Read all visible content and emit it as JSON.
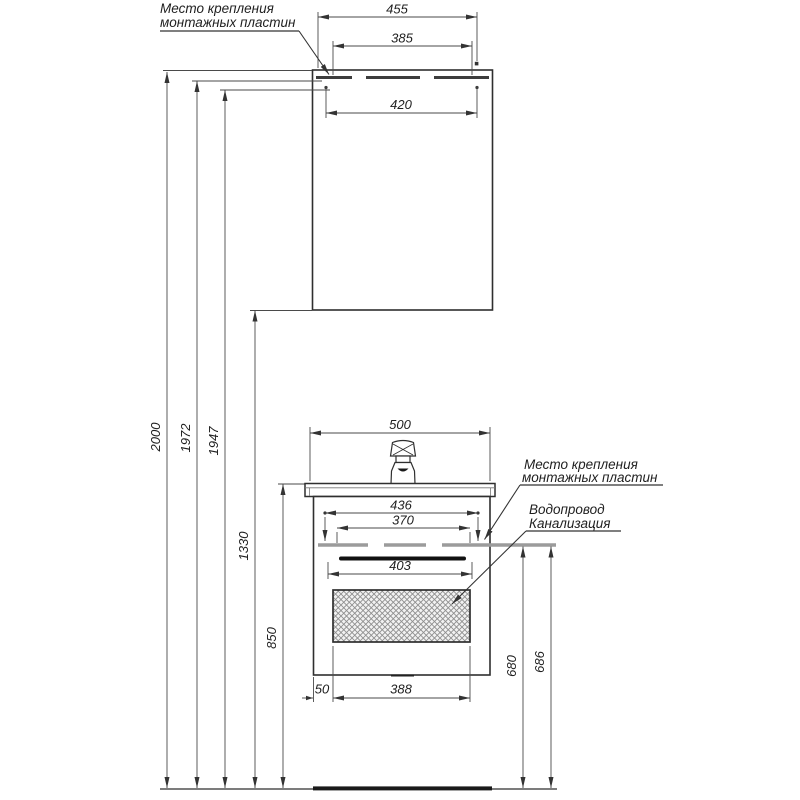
{
  "drawing": {
    "title_hint": "bathroom furniture installation drawing",
    "labels": {
      "mount_top_1": "Место крепления",
      "mount_top_2": "монтажных пластин",
      "mount_right_1": "Место крепления",
      "mount_right_2": "монтажных пластин",
      "water_supply": "Водопровод",
      "sewerage": "Канализация"
    },
    "dims": {
      "top_overall": "455",
      "top_mount": "385",
      "top_inner": "420",
      "h_total": "2000",
      "h_mount_upper": "1972",
      "h_mount_lower": "1947",
      "h_cabinet_bottom": "1330",
      "h_sink": "850",
      "vanity_width": "500",
      "vanity_mount": "436",
      "vanity_inner": "370",
      "handle_width": "403",
      "drawer_offset": "50",
      "drawer_width": "388",
      "h_front": "680",
      "h_back": "686"
    },
    "colors": {
      "outline": "#2f2f2f",
      "dim_line": "#4a4a4a",
      "mount_plate_gray": "#9b9b9b",
      "hatch": "#8f8f8f",
      "floor": "#1a1a1a"
    }
  }
}
